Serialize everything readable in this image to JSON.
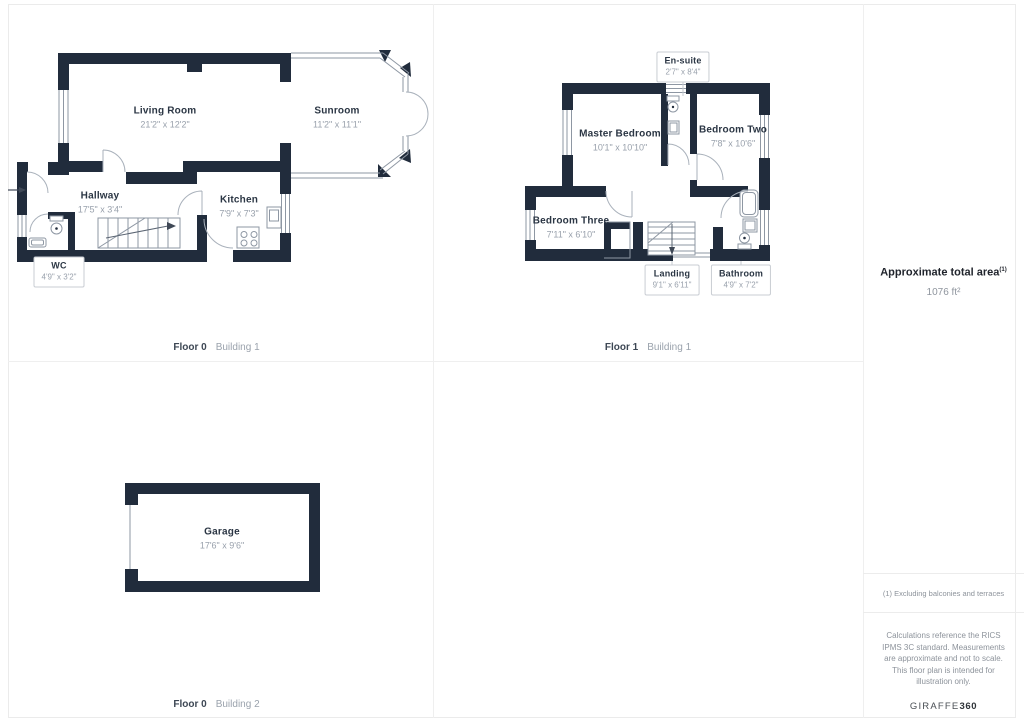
{
  "plans": {
    "floor0_building1": {
      "floor": "Floor 0",
      "building": "Building 1",
      "rooms": {
        "living_room": {
          "name": "Living Room",
          "dims": "21'2\" x 12'2\""
        },
        "sunroom": {
          "name": "Sunroom",
          "dims": "11'2\" x 11'1\""
        },
        "hallway": {
          "name": "Hallway",
          "dims": "17'5\" x 3'4\""
        },
        "kitchen": {
          "name": "Kitchen",
          "dims": "7'9\" x 7'3\""
        },
        "wc": {
          "name": "WC",
          "dims": "4'9\" x 3'2\""
        }
      }
    },
    "floor1_building1": {
      "floor": "Floor 1",
      "building": "Building 1",
      "rooms": {
        "en_suite": {
          "name": "En-suite",
          "dims": "2'7\" x 8'4\""
        },
        "master_bedroom": {
          "name": "Master Bedroom",
          "dims": "10'1\" x 10'10\""
        },
        "bedroom_two": {
          "name": "Bedroom Two",
          "dims": "7'8\" x 10'6\""
        },
        "bedroom_three": {
          "name": "Bedroom Three",
          "dims": "7'11\" x 6'10\""
        },
        "landing": {
          "name": "Landing",
          "dims": "9'1\" x 6'11\""
        },
        "bathroom": {
          "name": "Bathroom",
          "dims": "4'9\" x 7'2\""
        }
      }
    },
    "floor0_building2": {
      "floor": "Floor 0",
      "building": "Building 2",
      "rooms": {
        "garage": {
          "name": "Garage",
          "dims": "17'6\" x 9'6\""
        }
      }
    }
  },
  "sidebar": {
    "total_area_label": "Approximate total area",
    "total_area_note_ref": "(1)",
    "total_area_value": "1076 ft²",
    "footnote": "(1) Excluding balconies and terraces",
    "disclaimer": "Calculations reference the RICS IPMS 3C standard. Measurements are approximate and not to scale. This floor plan is intended for illustration only.",
    "brand_name": "GIRAFFE",
    "brand_suffix": "360"
  },
  "colors": {
    "wall": "#212c3c",
    "divider": "#efefef"
  }
}
